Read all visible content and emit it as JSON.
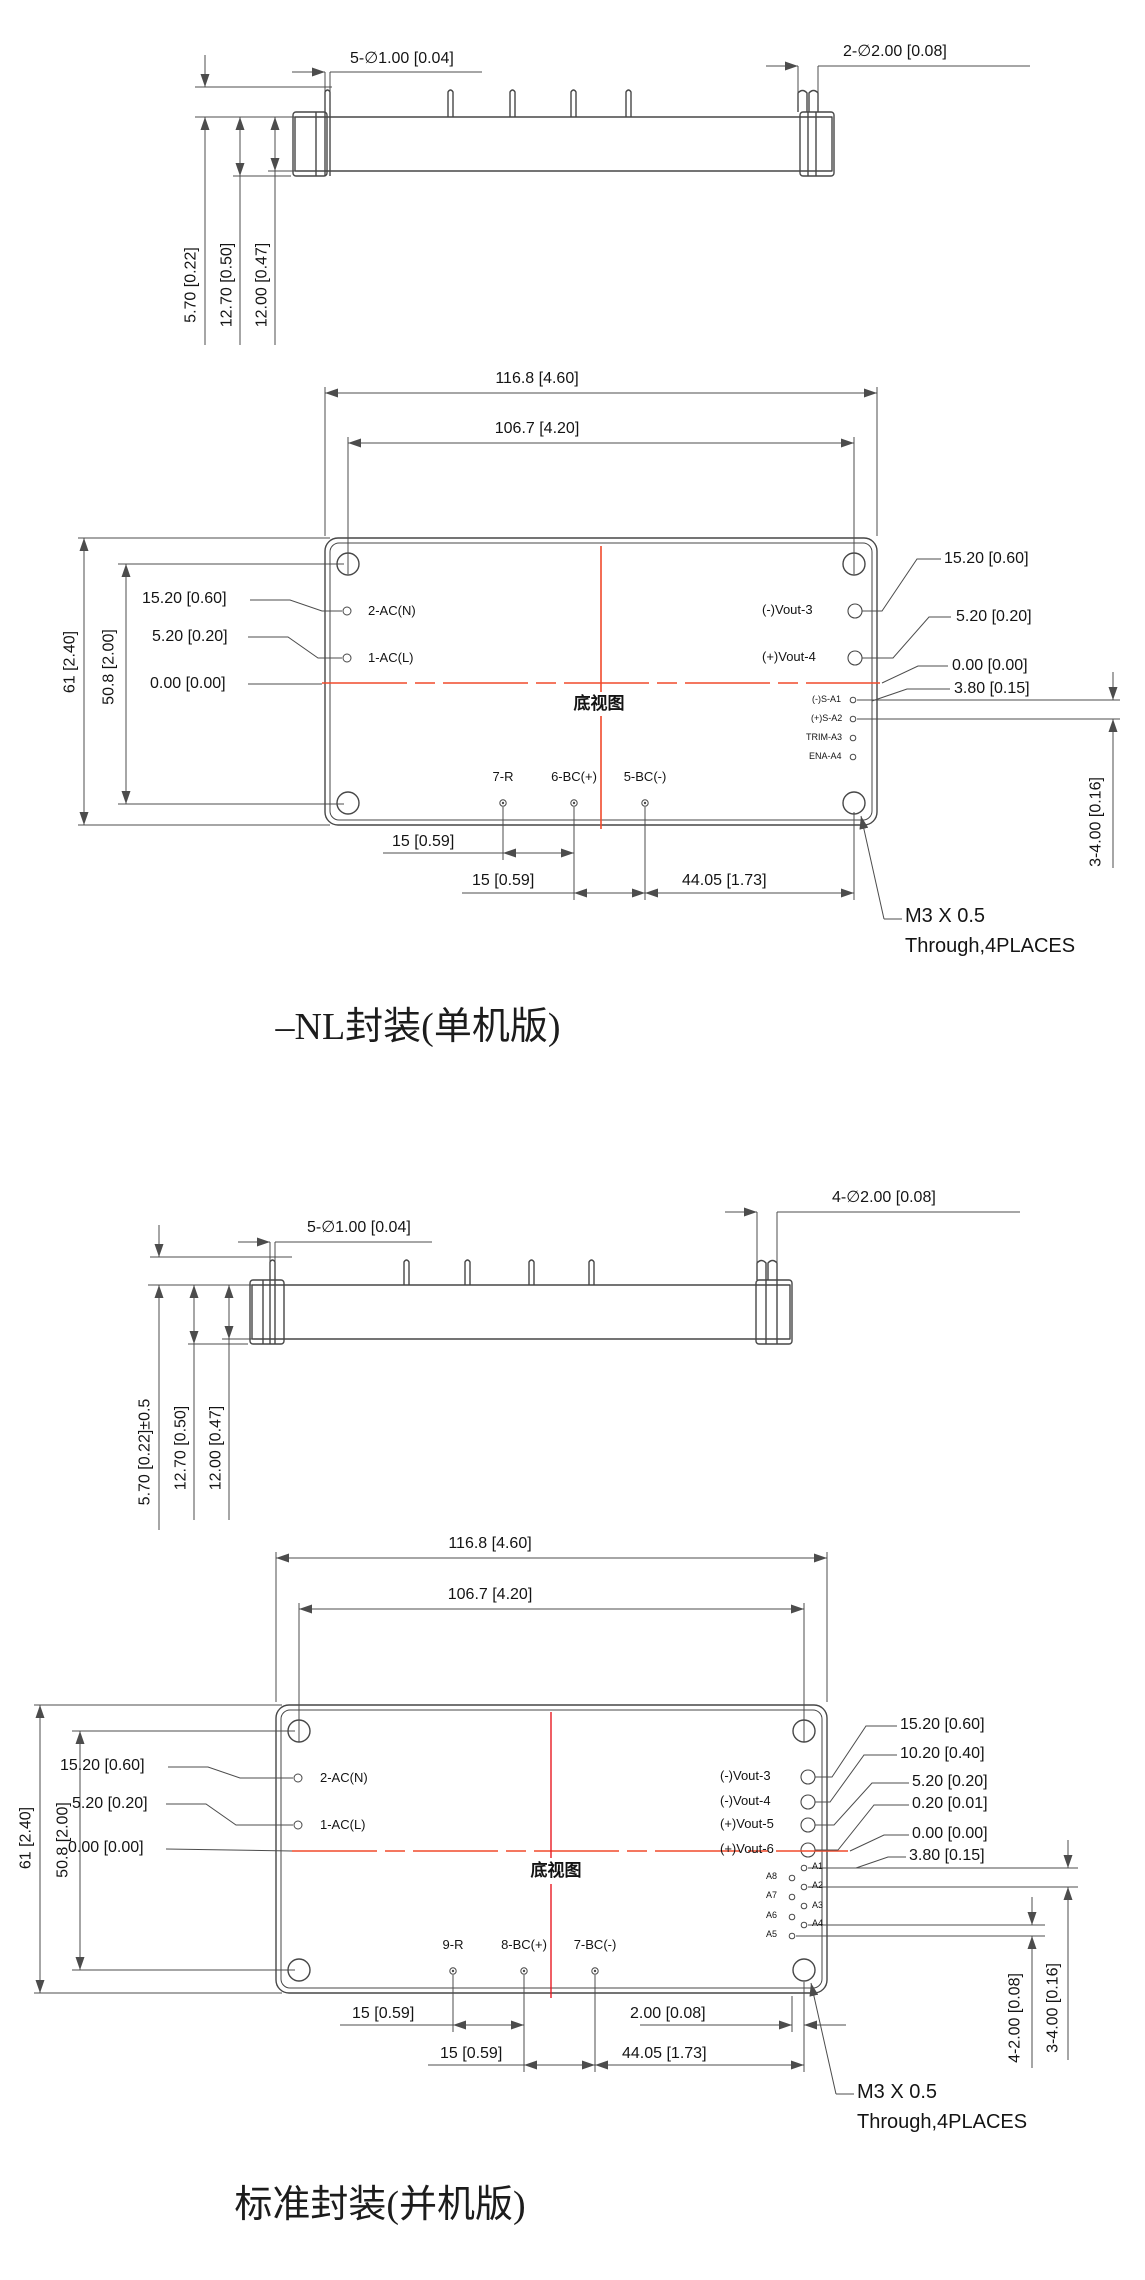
{
  "colors": {
    "line": "#4c4c4c",
    "text": "#141414",
    "centerline_orange": "#f04a2c",
    "centerline_red": "#e81b23"
  },
  "d1": {
    "title": "–NL封装(单机版)",
    "view_label": "底视图",
    "side": {
      "small_pins": "5-∅1.00 [0.04]",
      "large_pins": "2-∅2.00 [0.08]",
      "pin_height": "5.70 [0.22]",
      "total_height": "12.70 [0.50]",
      "body_height": "12.00 [0.47]"
    },
    "plan": {
      "width_outer": "116.8 [4.60]",
      "width_holes": "106.7 [4.20]",
      "height_outer": "61 [2.40]",
      "height_holes": "50.8 [2.00]",
      "left_dims": [
        "15.20 [0.60]",
        "5.20 [0.20]",
        "0.00 [0.00]"
      ],
      "left_pins": [
        "2-AC(N)",
        "1-AC(L)"
      ],
      "right_pins": [
        "(-)Vout-3",
        "(+)Vout-4"
      ],
      "signal_pins": [
        "(-)S-A1",
        "(+)S-A2",
        "TRIM-A3",
        "ENA-A4"
      ],
      "right_dims": [
        "15.20 [0.60]",
        "5.20 [0.20]",
        "0.00 [0.00]",
        "3.80 [0.15]"
      ],
      "signal_pitch": "3-4.00 [0.16]",
      "bottom_pins": [
        "7-R",
        "6-BC(+)",
        "5-BC(-)"
      ],
      "bottom_dims": [
        "15 [0.59]",
        "15 [0.59]",
        "44.05 [1.73]"
      ],
      "note1": "M3 X 0.5",
      "note2": "Through,4PLACES"
    }
  },
  "d2": {
    "title": "标准封装(并机版)",
    "view_label": "底视图",
    "side": {
      "small_pins": "5-∅1.00 [0.04]",
      "large_pins": "4-∅2.00 [0.08]",
      "pin_height": "5.70 [0.22]±0.5",
      "total_height": "12.70 [0.50]",
      "body_height": "12.00 [0.47]"
    },
    "plan": {
      "width_outer": "116.8 [4.60]",
      "width_holes": "106.7 [4.20]",
      "height_outer": "61 [2.40]",
      "height_holes": "50.8 [2.00]",
      "left_dims": [
        "15.20 [0.60]",
        "5.20 [0.20]",
        "0.00 [0.00]"
      ],
      "left_pins": [
        "2-AC(N)",
        "1-AC(L)"
      ],
      "right_pins": [
        "(-)Vout-3",
        "(-)Vout-4",
        "(+)Vout-5",
        "(+)Vout-6"
      ],
      "a_pins_right": [
        "A1",
        "A2",
        "A3",
        "A4"
      ],
      "a_pins_left": [
        "A8",
        "A7",
        "A6",
        "A5"
      ],
      "right_dims": [
        "15.20 [0.60]",
        "10.20 [0.40]",
        "5.20 [0.20]",
        "0.20 [0.01]",
        "0.00 [0.00]",
        "3.80 [0.15]"
      ],
      "signal_pitch": "3-4.00 [0.16]",
      "stagger": "4-2.00 [0.08]",
      "bottom_pins": [
        "9-R",
        "8-BC(+)",
        "7-BC(-)"
      ],
      "bottom_dims": [
        "15 [0.59]",
        "15 [0.59]",
        "2.00 [0.08]",
        "44.05 [1.73]"
      ],
      "note1": "M3 X 0.5",
      "note2": "Through,4PLACES"
    }
  }
}
